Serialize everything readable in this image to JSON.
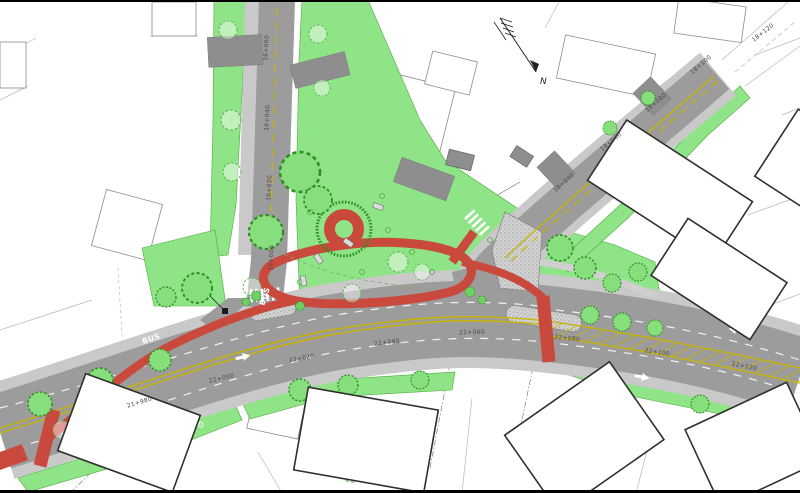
{
  "drawing": {
    "kind": "street and intersection improvement plan",
    "north_label": "N"
  },
  "colors": {
    "asphalt": "#9c9c9c",
    "sidewalk": "#c9c9c9",
    "driveway": "#8e8e8e",
    "green": "#8fe487",
    "tree_outline": "#2e8f22",
    "red_path": "#c94a3d",
    "lane_yellow": "#c9b400",
    "marking_white": "#ffffff",
    "building_outline": "#2f2f2f",
    "survey_line": "#b8b8b8",
    "station_text": "#4a4a4a"
  },
  "markings": {
    "bus1": "BUS",
    "bus2": "BUS"
  },
  "stations": {
    "main": [
      "21+980",
      "22+000",
      "22+020",
      "22+040",
      "22+060",
      "22+080",
      "22+100",
      "22+120"
    ],
    "northeast": [
      "18+040",
      "18+060",
      "18+080",
      "18+100",
      "18+120"
    ],
    "north": [
      "16+000",
      "16+020",
      "16+040",
      "16+060"
    ]
  }
}
